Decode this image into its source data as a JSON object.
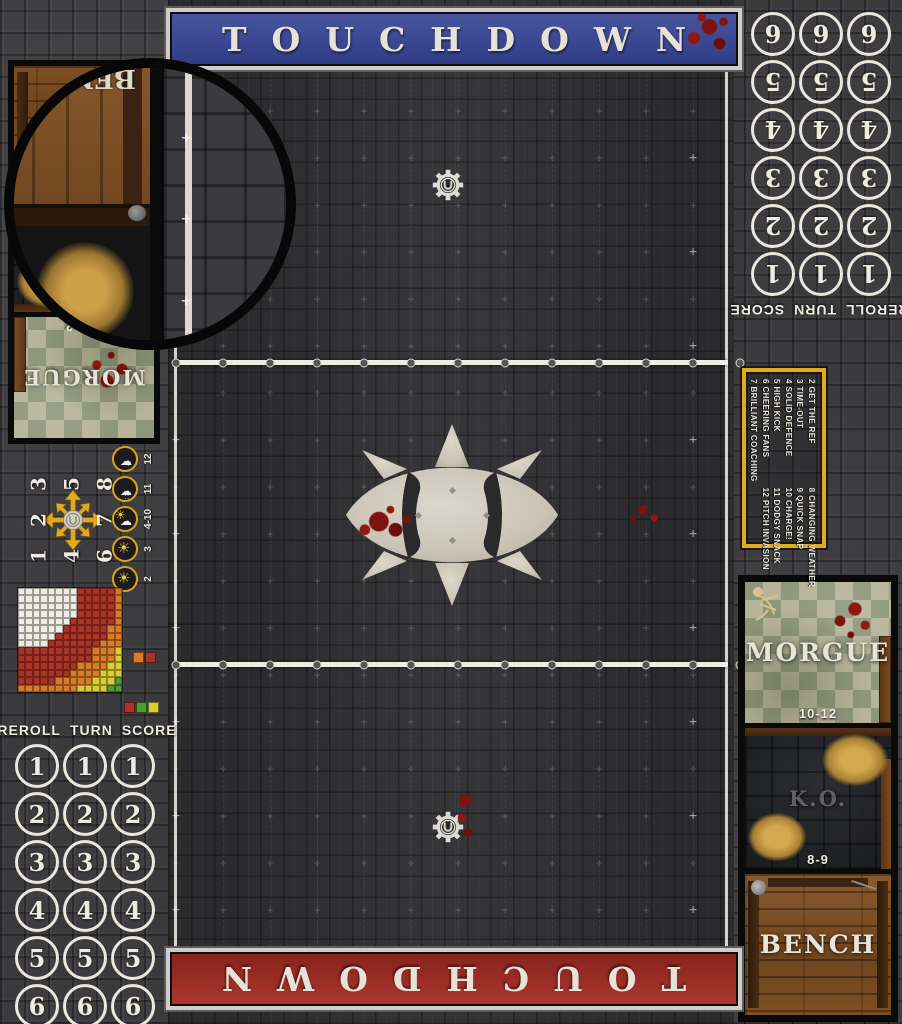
{
  "banners": {
    "top": {
      "label": "TOUCHDOWN",
      "color": "#3e4d97"
    },
    "bottom": {
      "label": "TOUCHDOWN",
      "color": "#a13029"
    }
  },
  "tracks": {
    "header": [
      "REROLL",
      "TURN",
      "SCORE"
    ],
    "numbers": [
      "1",
      "2",
      "3",
      "4",
      "5",
      "6"
    ],
    "columns": 3
  },
  "scatter": {
    "grid": [
      "3",
      "5",
      "8",
      "2",
      "",
      "7",
      "1",
      "4",
      "6"
    ]
  },
  "weather": [
    {
      "label": "12",
      "icon": "snow-cloud-icon"
    },
    {
      "label": "11",
      "icon": "rain-cloud-icon"
    },
    {
      "label": "4-10",
      "icon": "sun-cloud-icon"
    },
    {
      "label": "3",
      "icon": "sun-icon"
    },
    {
      "label": "2",
      "icon": "sun-icon"
    }
  ],
  "kickoff": {
    "column1": [
      "2 GET THE REF",
      "3 TIME-OUT",
      "4 SOLID DEFENCE",
      "5 HIGH KICK",
      "6 CHEERING FANS",
      "7 BRILLIANT COACHING"
    ],
    "column2": [
      "8 CHANGING WEATHER",
      "9 QUICK SNAP",
      "10 CHARGE!",
      "11 DODGY SNACK",
      "12 PITCH INVASION"
    ]
  },
  "dugout": {
    "sections": [
      {
        "label": "MORGUE",
        "range": "10-12"
      },
      {
        "label": "K.O.",
        "range": "8-9"
      },
      {
        "label": "BENCH",
        "range": ""
      }
    ]
  },
  "range_chart": {
    "type": "heatmap",
    "grid_size": 14,
    "bands": [
      {
        "color": "#efece2",
        "max": 8.5
      },
      {
        "color": "#ab3226",
        "max": 13.5
      },
      {
        "color": "#d97c27",
        "max": 15.8
      },
      {
        "color": "#d9cf35",
        "max": 17.8
      },
      {
        "color": "#4e9a3b",
        "max": 99
      }
    ],
    "legend_pair": [
      "#d97c27",
      "#ab3226"
    ],
    "legend_triple": [
      "#ab3226",
      "#4e9a3b",
      "#d9cf35"
    ]
  },
  "colors": {
    "accent_yellow": "#e2ab1e",
    "blood": "#8e1812",
    "banner_blue": "#3e4d97",
    "banner_red": "#a13029"
  }
}
